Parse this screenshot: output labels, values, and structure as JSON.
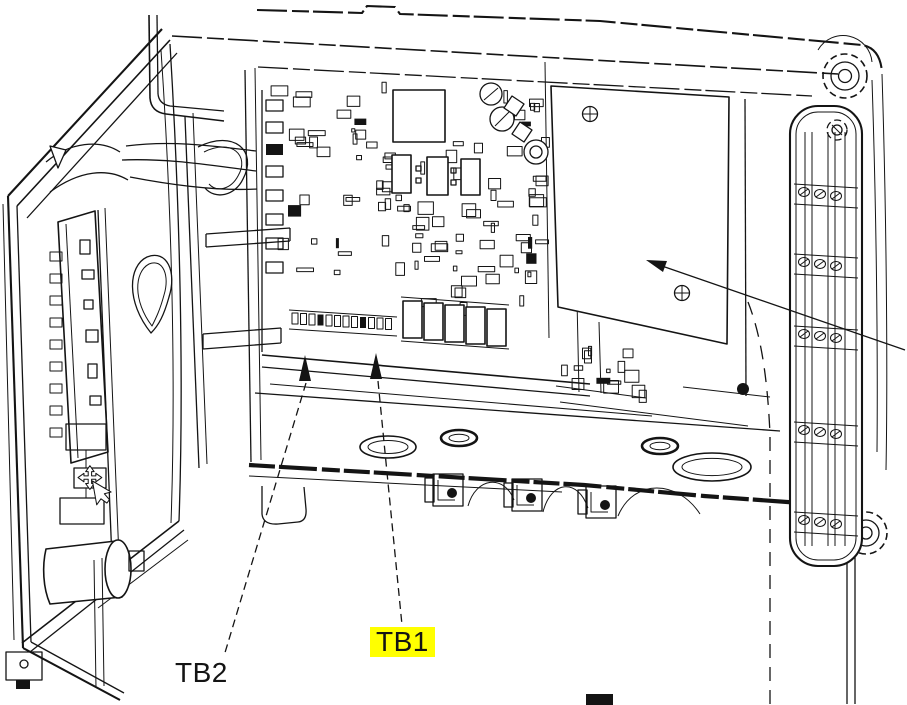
{
  "colors": {
    "ink": "#141414",
    "background": "#ffffff",
    "highlight": "#ffff00"
  },
  "figure": {
    "alt": "Black-and-white line illustration of an open field-transmitter enclosure: hinged door with display board at left, main circuit board with terminal blocks inside, blank cover plate and hinge rail at right",
    "labels": {
      "tb2": {
        "text": "TB2",
        "highlighted": false
      },
      "tb1": {
        "text": "TB1",
        "highlighted": true
      }
    },
    "callouts": [
      {
        "label": "TB2",
        "style": "dashed leader, solid arrowhead pointing up at left terminal block"
      },
      {
        "label": "TB1",
        "style": "dashed leader, solid arrowhead pointing up at right terminal block"
      },
      {
        "label": "",
        "style": "solid leader from right edge, arrowhead pointing at blank cover plate"
      }
    ]
  }
}
